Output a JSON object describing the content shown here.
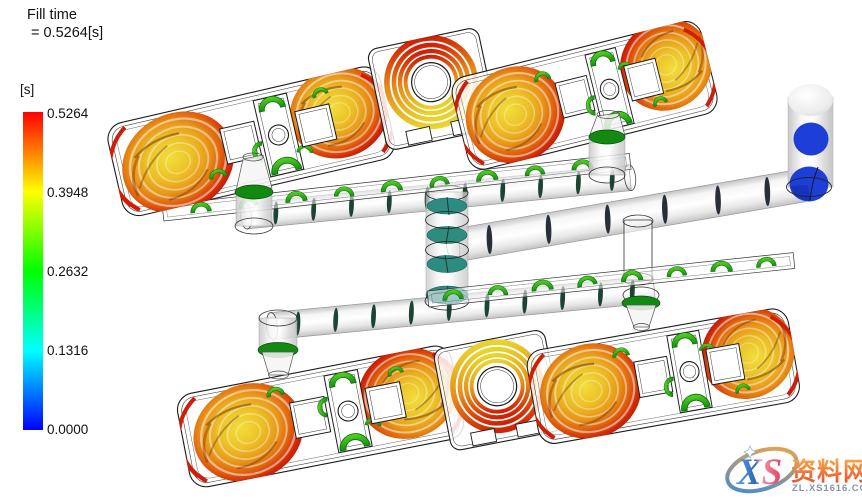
{
  "header": {
    "title_line1": "Fill time",
    "title_line2": "= 0.5264[s]"
  },
  "legend": {
    "unit": "[s]",
    "ticks": [
      "0.5264",
      "0.3948",
      "0.2632",
      "0.1316",
      "0.0000"
    ],
    "stops": [
      "#ff0000",
      "#ffff00",
      "#00ff00",
      "#00ffff",
      "#0000ff"
    ]
  },
  "scene": {
    "palette": {
      "teal_disc": "#2e8b80",
      "green_disc": "#128a12",
      "blue_disc": "#1e3ed8",
      "slice_dark_green": "#1b4433",
      "slice_dark_navy": "#273039",
      "arc_green_light": "#58d423",
      "arc_green_dark": "#129010",
      "contour_red": "#cf1d06"
    }
  },
  "watermark": {
    "logo": "XS",
    "site": "资料网",
    "url": "ZL.XS1616.COM"
  },
  "chart_data": {
    "type": "heatmap",
    "title": "Fill time",
    "result_label": "= 0.5264[s]",
    "unit": "s",
    "colorbar": {
      "min": 0.0,
      "max": 0.5264,
      "ticks": [
        0.5264,
        0.3948,
        0.2632,
        0.1316,
        0.0
      ],
      "colormap_low_to_high": [
        "#0000ff",
        "#00ffff",
        "#00ff00",
        "#ffff00",
        "#ff0000"
      ],
      "orientation": "vertical",
      "position": "left"
    },
    "content": "3D mold-filling isochrone plot: blue (0 s) at sprue/runner entry on right, teal/green fronts along runner tubes and gates, yellow-orange-red fronts (up to 0.5264 s) in the four cavity clusters last to fill"
  }
}
